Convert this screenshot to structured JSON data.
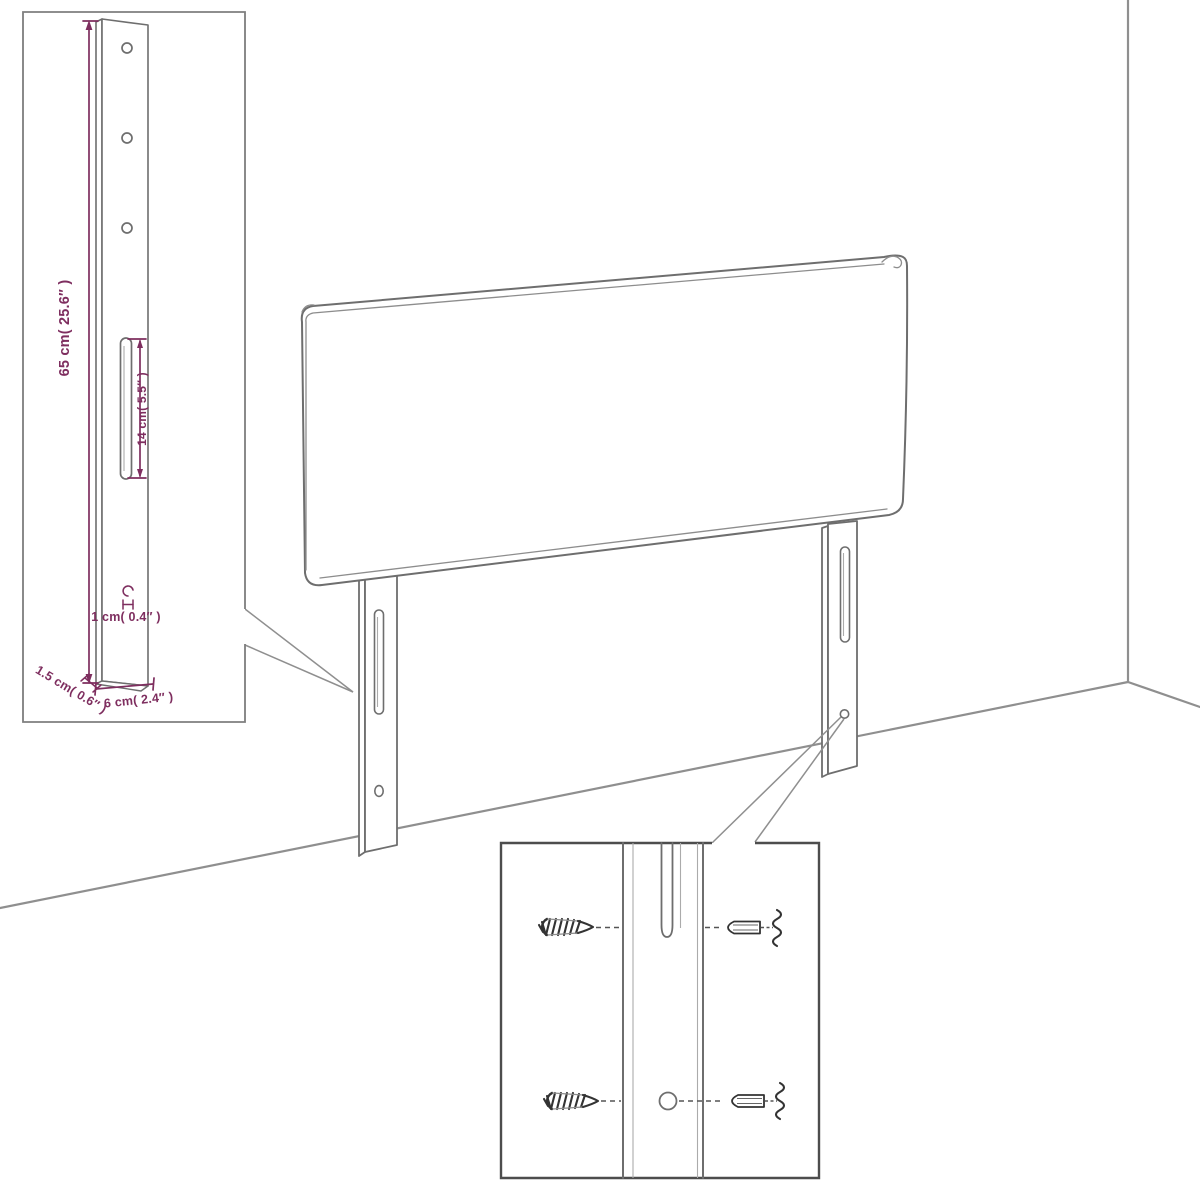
{
  "colors": {
    "accent": "#7e2e5f",
    "line": "#6e6e6e",
    "room": "#8f8f8f",
    "hardware": "#333333"
  },
  "inset_leg_detail": {
    "height_label": "65 cm( 25.6″ )",
    "slot_label": "14 cm( 5.5″ )",
    "hole_label": "1 cm( 0.4″ )",
    "thickness_label": "1.5 cm( 0.6″ )",
    "width_label": "6 cm( 2.4″ )"
  }
}
